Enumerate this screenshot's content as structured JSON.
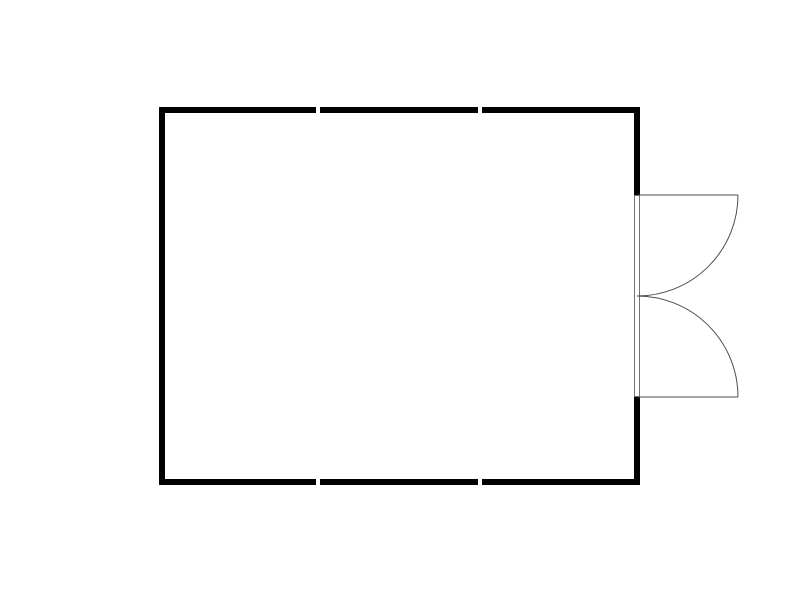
{
  "canvas": {
    "width": 800,
    "height": 600,
    "background": "#ffffff"
  },
  "colors": {
    "wall": "#000000",
    "door_line": "#4d4d4d",
    "door_frame_border": "#737373",
    "fill": "#ffffff"
  },
  "plan": {
    "description": "Rectangular room floor plan; top and bottom walls drawn as three segments with small joint gaps; outward-opening double door centered on the right wall with quarter-circle swing arcs",
    "room_bounds": {
      "x": 159,
      "y": 107,
      "width": 481,
      "height": 378
    },
    "wall_thickness": 6,
    "walls": [
      {
        "name": "wall-top-left-segment",
        "x": 159,
        "y": 107,
        "w": 157,
        "h": 6
      },
      {
        "name": "wall-top-middle-segment",
        "x": 320,
        "y": 107,
        "w": 158,
        "h": 6
      },
      {
        "name": "wall-top-right-segment",
        "x": 482,
        "y": 107,
        "w": 158,
        "h": 6
      },
      {
        "name": "wall-bottom-left-segment",
        "x": 159,
        "y": 479,
        "w": 157,
        "h": 6
      },
      {
        "name": "wall-bottom-middle-segment",
        "x": 320,
        "y": 479,
        "w": 158,
        "h": 6
      },
      {
        "name": "wall-bottom-right-segment",
        "x": 482,
        "y": 479,
        "w": 158,
        "h": 6
      },
      {
        "name": "wall-left",
        "x": 159,
        "y": 107,
        "w": 6,
        "h": 378
      },
      {
        "name": "wall-right-upper",
        "x": 634,
        "y": 107,
        "w": 6,
        "h": 88
      },
      {
        "name": "wall-right-lower",
        "x": 634,
        "y": 397,
        "w": 6,
        "h": 88
      }
    ],
    "door": {
      "name": "double-door",
      "opening": {
        "top": 195,
        "bottom": 397
      },
      "frame": {
        "x": 634,
        "y": 195,
        "w": 6,
        "h": 202
      },
      "leaves": [
        {
          "name": "door-leaf-top",
          "hinge": [
            637,
            195
          ],
          "end": [
            738,
            195
          ],
          "arc_end": [
            637,
            296
          ],
          "sweep": 1
        },
        {
          "name": "door-leaf-bottom",
          "hinge": [
            637,
            397
          ],
          "end": [
            738,
            397
          ],
          "arc_end": [
            637,
            296
          ],
          "sweep": 0
        }
      ]
    }
  }
}
